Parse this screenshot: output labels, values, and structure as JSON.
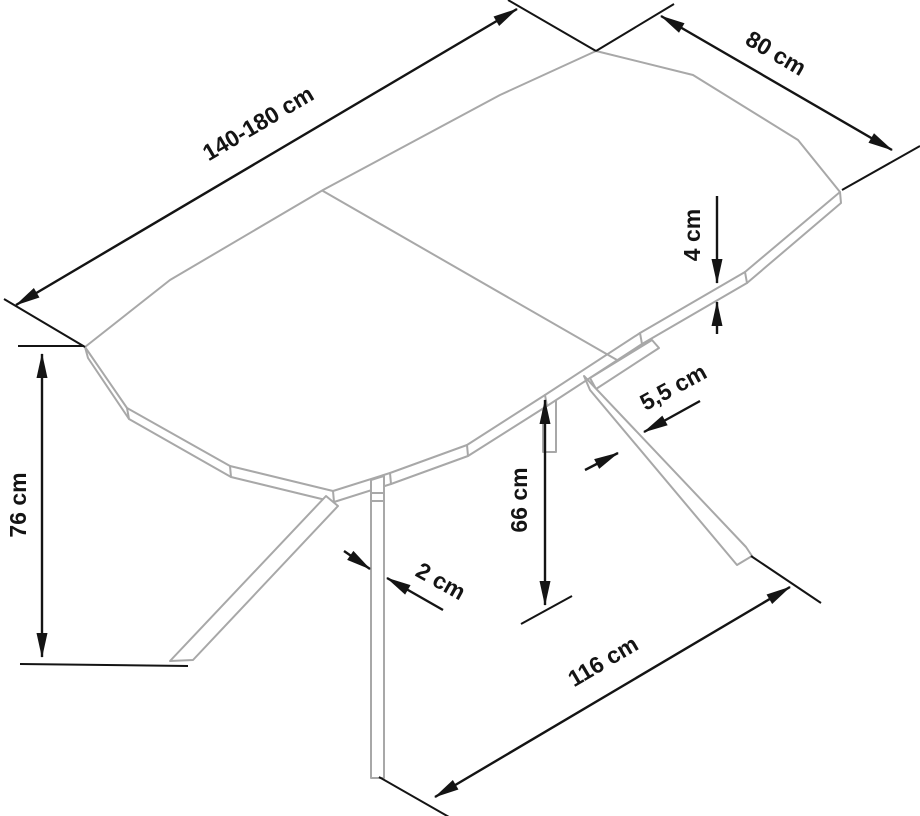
{
  "diagram": {
    "type": "furniture-dimension-drawing",
    "subject": "extendable-table",
    "unit": "cm",
    "colors": {
      "drawing": "#a8a8a8",
      "dimension": "#141414",
      "text": "#141414",
      "background": "#ffffff"
    },
    "dimensions": {
      "length": "140-180 cm",
      "end_width": "80 cm",
      "top_thickness": "4 cm",
      "height": "76 cm",
      "underside_clearance": "66 cm",
      "leg_profile_width": "5,5 cm",
      "front_leg_thickness": "2 cm",
      "base_span": "116 cm"
    }
  }
}
